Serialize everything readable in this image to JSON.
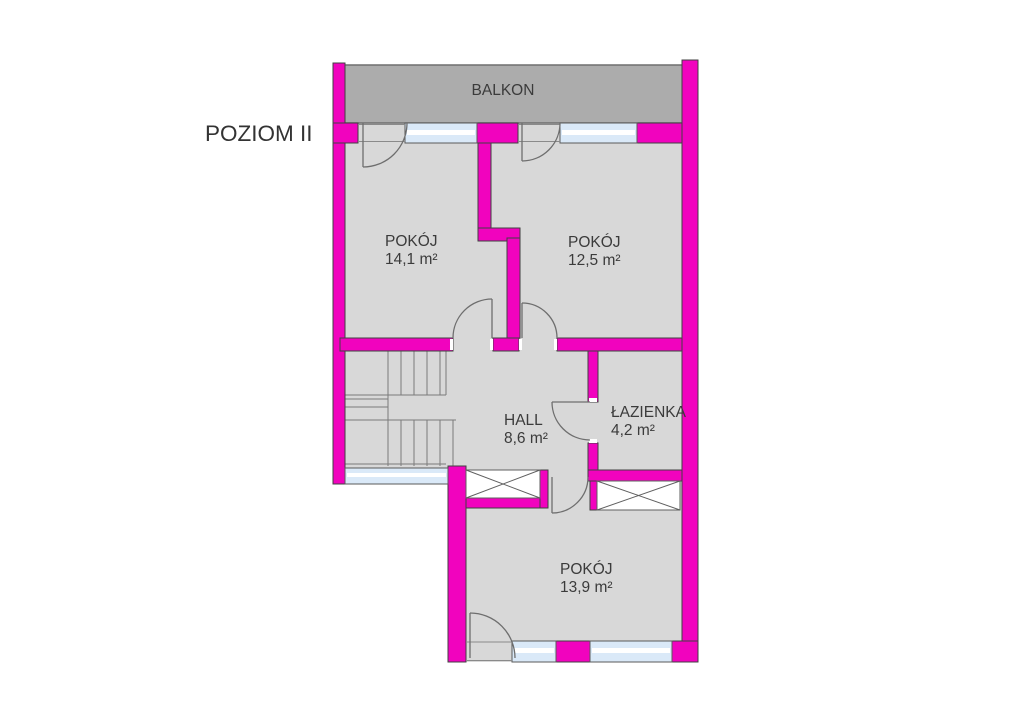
{
  "title": "POZIOM II",
  "balcony": {
    "label": "BALKON"
  },
  "rooms": [
    {
      "name": "POKÓJ",
      "area": "14,1 m²"
    },
    {
      "name": "POKÓJ",
      "area": "12,5 m²"
    },
    {
      "name": "HALL",
      "area": "8,6 m²"
    },
    {
      "name": "ŁAZIENKA",
      "area": "4,2 m²"
    },
    {
      "name": "POKÓJ",
      "area": "13,9 m²"
    }
  ],
  "colors": {
    "wall": "#F103BE",
    "outline": "#414141",
    "floor": "#D8D8D8",
    "balcony": "#ACACAC",
    "balcony_border": "#6F6F6F",
    "window": "#DAE9F8",
    "text": "#3B3B3B"
  }
}
